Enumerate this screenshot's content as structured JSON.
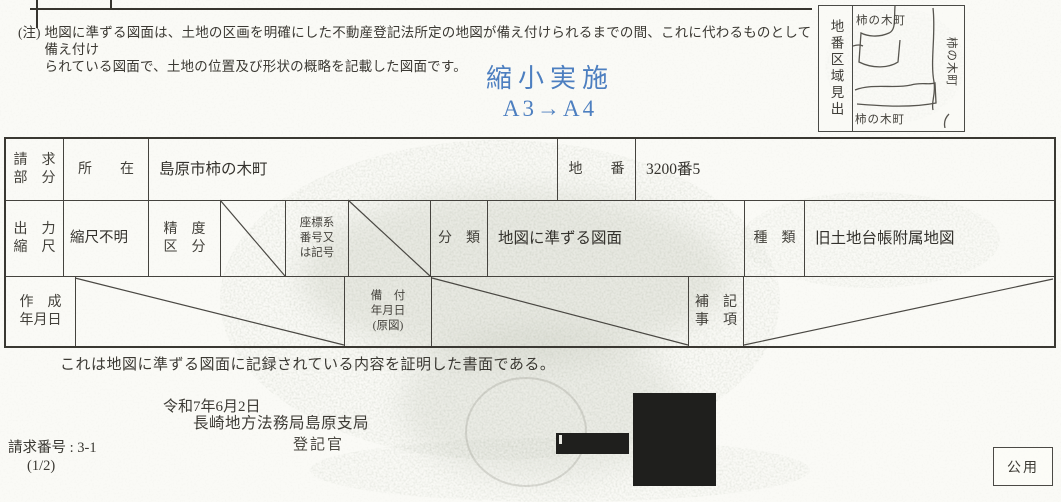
{
  "colors": {
    "paper": "#fafaf6",
    "ink": "#3c3a35",
    "accent-blue": "#4d7fc0",
    "border": "#45433e",
    "redaction": "#1f1f1d"
  },
  "note": {
    "prefix": "(注)",
    "line1": "地図に準ずる図面は、土地の区画を明確にした不動産登記法所定の地図が備え付けられるまでの間、これに代わるものとして備え付け",
    "line2": "られている図面で、土地の位置及び形状の概略を記載した図面です。"
  },
  "reduction_stamp": {
    "line1": "縮小実施",
    "line2": "A3→A4"
  },
  "inset_map": {
    "side_label": "地番区域見出",
    "label_top": "柿の木町",
    "label_right": "柿の木町",
    "label_bottom": "柿の木町"
  },
  "table": {
    "request_section": {
      "l1": "請　求",
      "l2": "部　分"
    },
    "location_label": "所　　在",
    "location_value": "島原市柿の木町",
    "parcel_label": "地　　番",
    "parcel_value": "3200番5",
    "output_scale_label": {
      "l1": "出　力",
      "l2": "縮　尺"
    },
    "output_scale_value": "縮尺不明",
    "precision_label": {
      "l1": "精　度",
      "l2": "区　分"
    },
    "coord_label": {
      "l1": "座標系",
      "l2": "番号又",
      "l3": "は記号"
    },
    "class_label": "分　類",
    "class_value": "地図に準ずる図面",
    "kind_label": "種　類",
    "kind_value": "旧土地台帳附属地図",
    "created_label": {
      "l1": "作　成",
      "l2": "年月日"
    },
    "equipped_label": {
      "l1": "備　付",
      "l2": "年月日",
      "l3": "(原図)"
    },
    "notes_label": {
      "l1": "補　記",
      "l2": "事　項"
    }
  },
  "certify_statement": "これは地図に準ずる図面に記録されている内容を証明した書面である。",
  "issue": {
    "date": "令和7年6月2日",
    "office": "長崎地方法務局島原支局",
    "officer_label": "登記官"
  },
  "request": {
    "number": "請求番号 : 3-1",
    "page": "(1/2)"
  },
  "official_use_label": "公用"
}
